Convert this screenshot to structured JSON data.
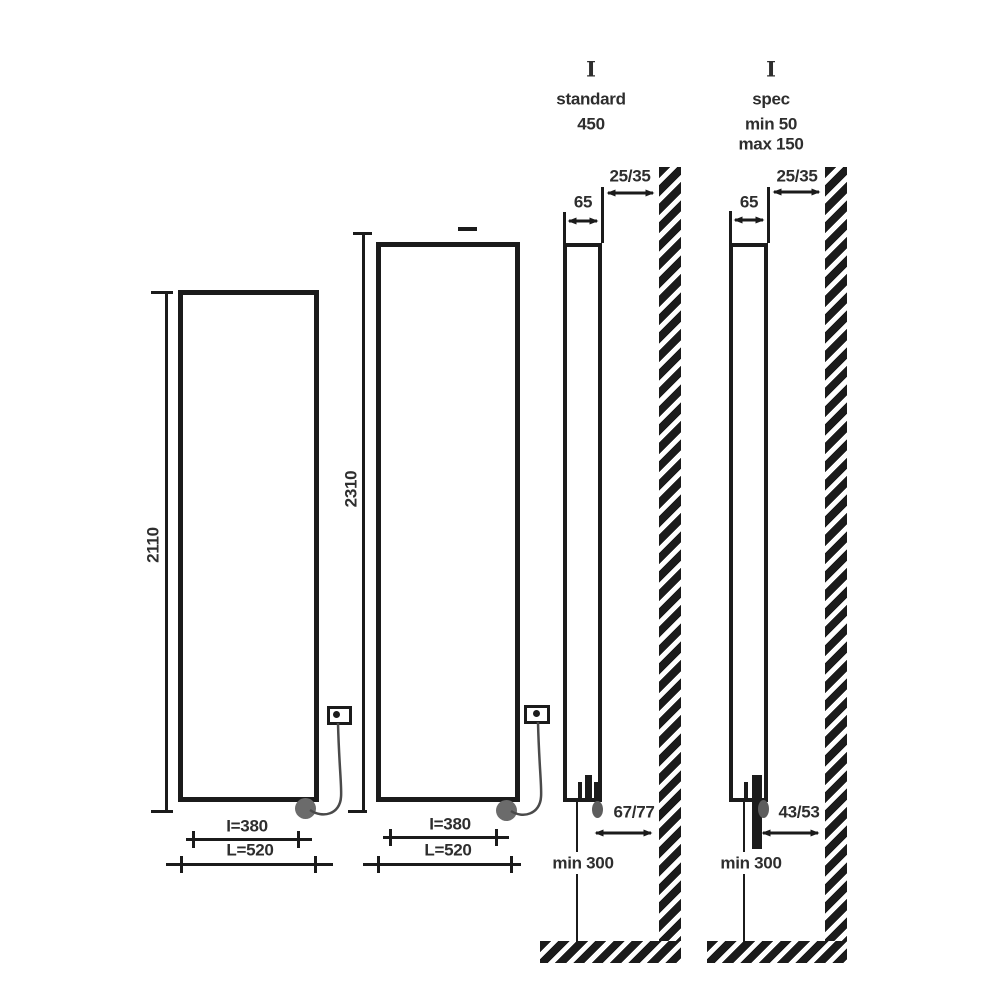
{
  "front_views": [
    {
      "height": "2110",
      "inner_width": "I=380",
      "outer_width": "L=520"
    },
    {
      "height": "2310",
      "inner_width": "I=380",
      "outer_width": "L=520"
    }
  ],
  "side_views": [
    {
      "type_mark": "I",
      "variant": "standard",
      "values": [
        "450"
      ],
      "depth": "65",
      "wall_gap": "25/35",
      "outlet_offset": "67/77",
      "floor_clearance": "min 300"
    },
    {
      "type_mark": "I",
      "variant": "spec",
      "values": [
        "min 50",
        "max 150"
      ],
      "depth": "65",
      "wall_gap": "25/35",
      "outlet_offset": "43/53",
      "floor_clearance": "min 300"
    }
  ],
  "colors": {
    "line": "#1b1b1b",
    "text": "#2e2e2e",
    "connector": "#6b6b6b"
  }
}
